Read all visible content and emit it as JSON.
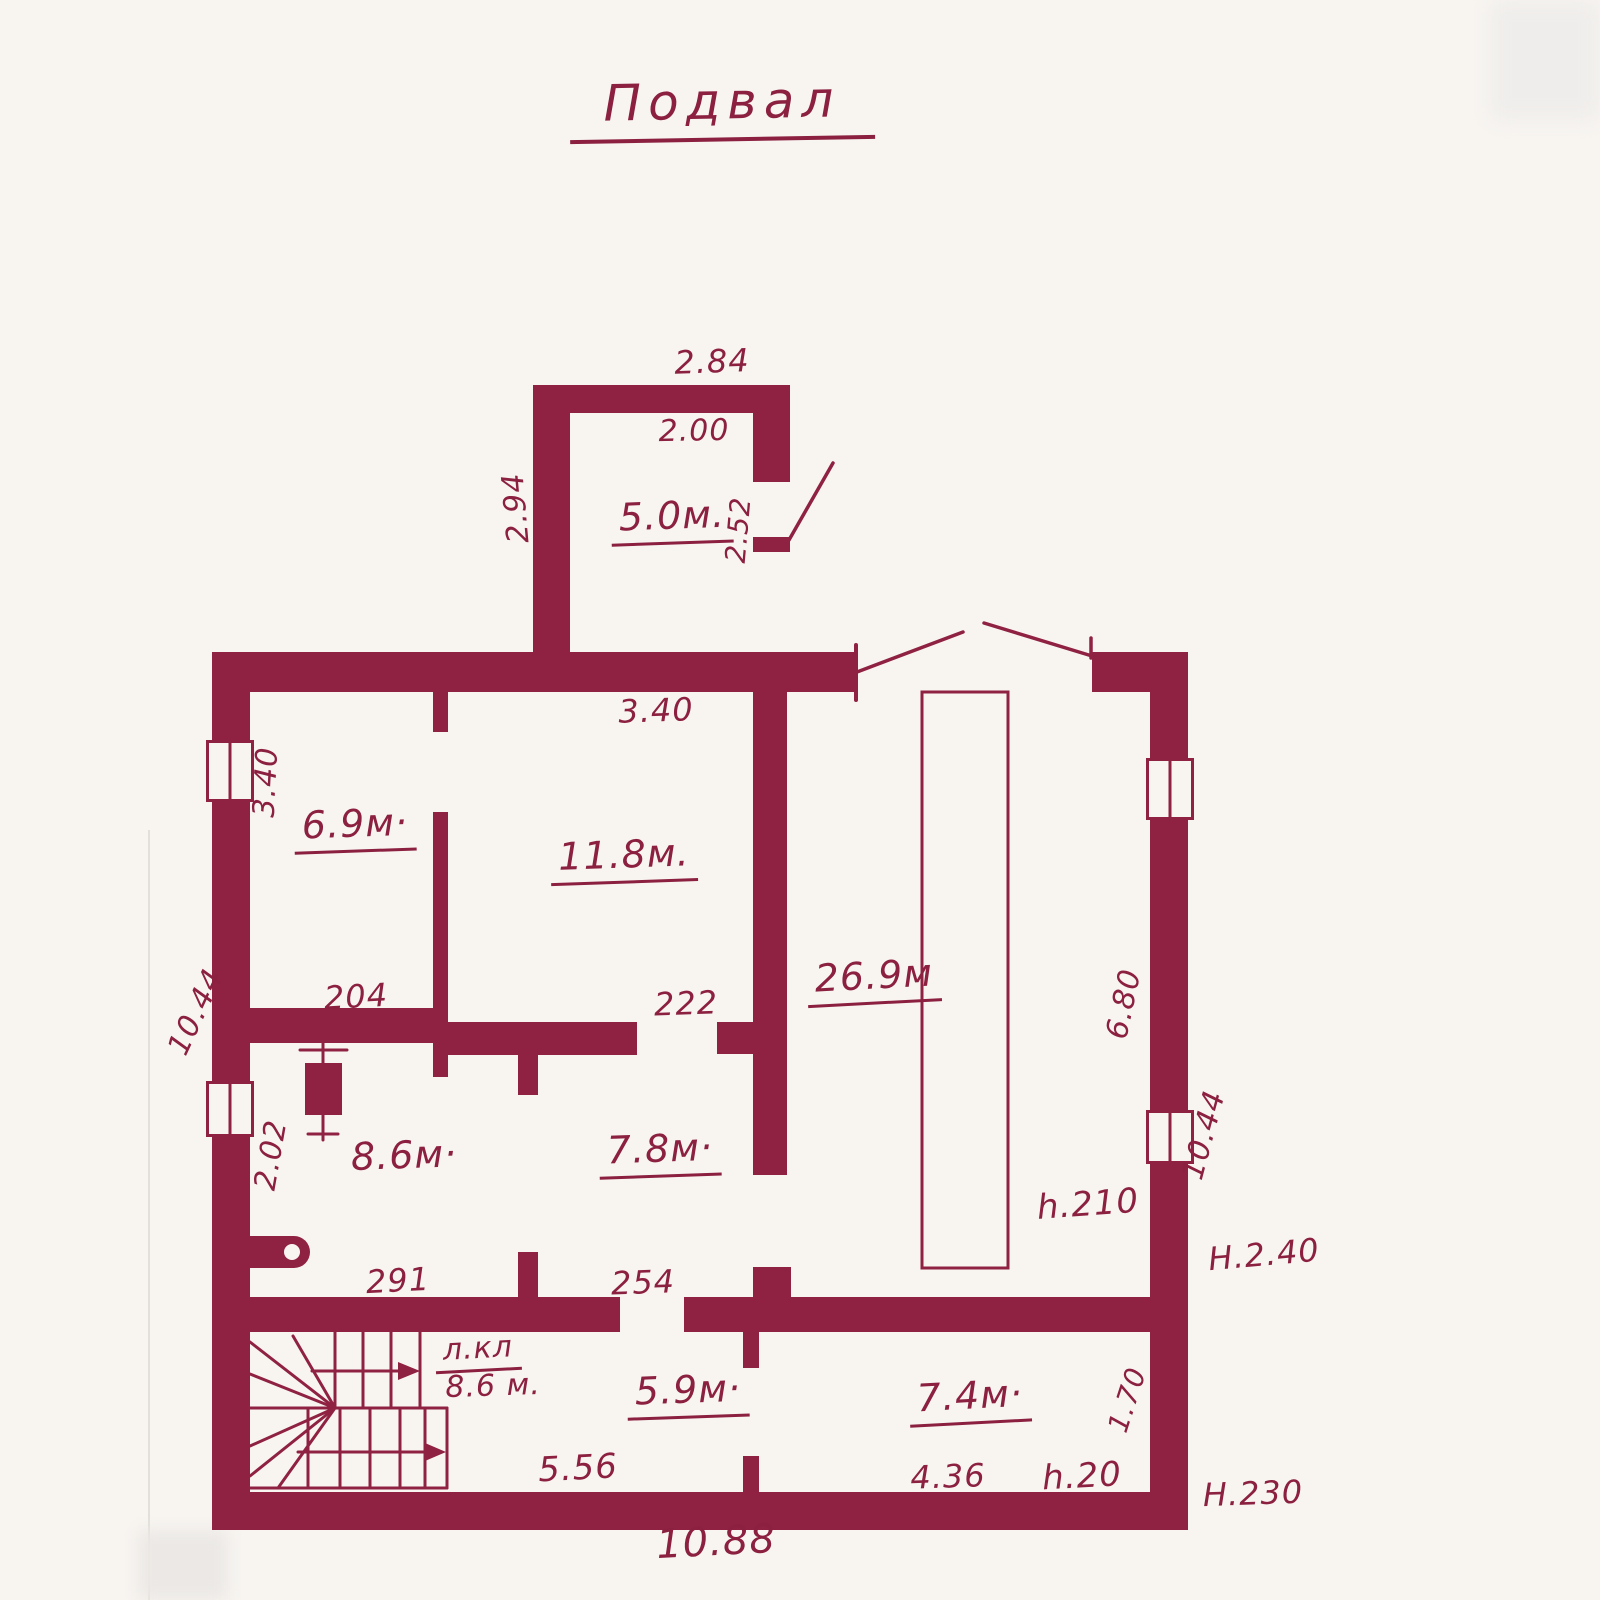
{
  "title": "Подвал",
  "colors": {
    "ink": "#8f2243",
    "paper": "#f8f5f1"
  },
  "annex": {
    "area": "5.0м.",
    "width_outer": "2.84",
    "width_inner": "2.00",
    "height_left": "2.94",
    "door_height": "2.52"
  },
  "rooms": {
    "r69": "6.9м·",
    "r118": "11.8м.",
    "r269": "26.9м",
    "r86": "8.6м·",
    "r78": "7.8м·",
    "stair_name": "л.кл",
    "stair_area": "8.6 м.",
    "r59": "5.9м·",
    "r74": "7.4м·"
  },
  "dims": {
    "top_340": "3.40",
    "left_340": "3.40",
    "d204": "204",
    "d222": "222",
    "d680": "6.80",
    "left_1044": "10.44",
    "right_1044": "10.44",
    "d202": "2.02",
    "d291": "291",
    "d254": "254",
    "d556": "5.56",
    "d436": "4.36",
    "d170": "1.70",
    "d1088": "10.88"
  },
  "heights": {
    "garage": "h.210",
    "right_outer": "H.2.40",
    "corner_room": "h.20",
    "bottom_outer": "H.230"
  }
}
